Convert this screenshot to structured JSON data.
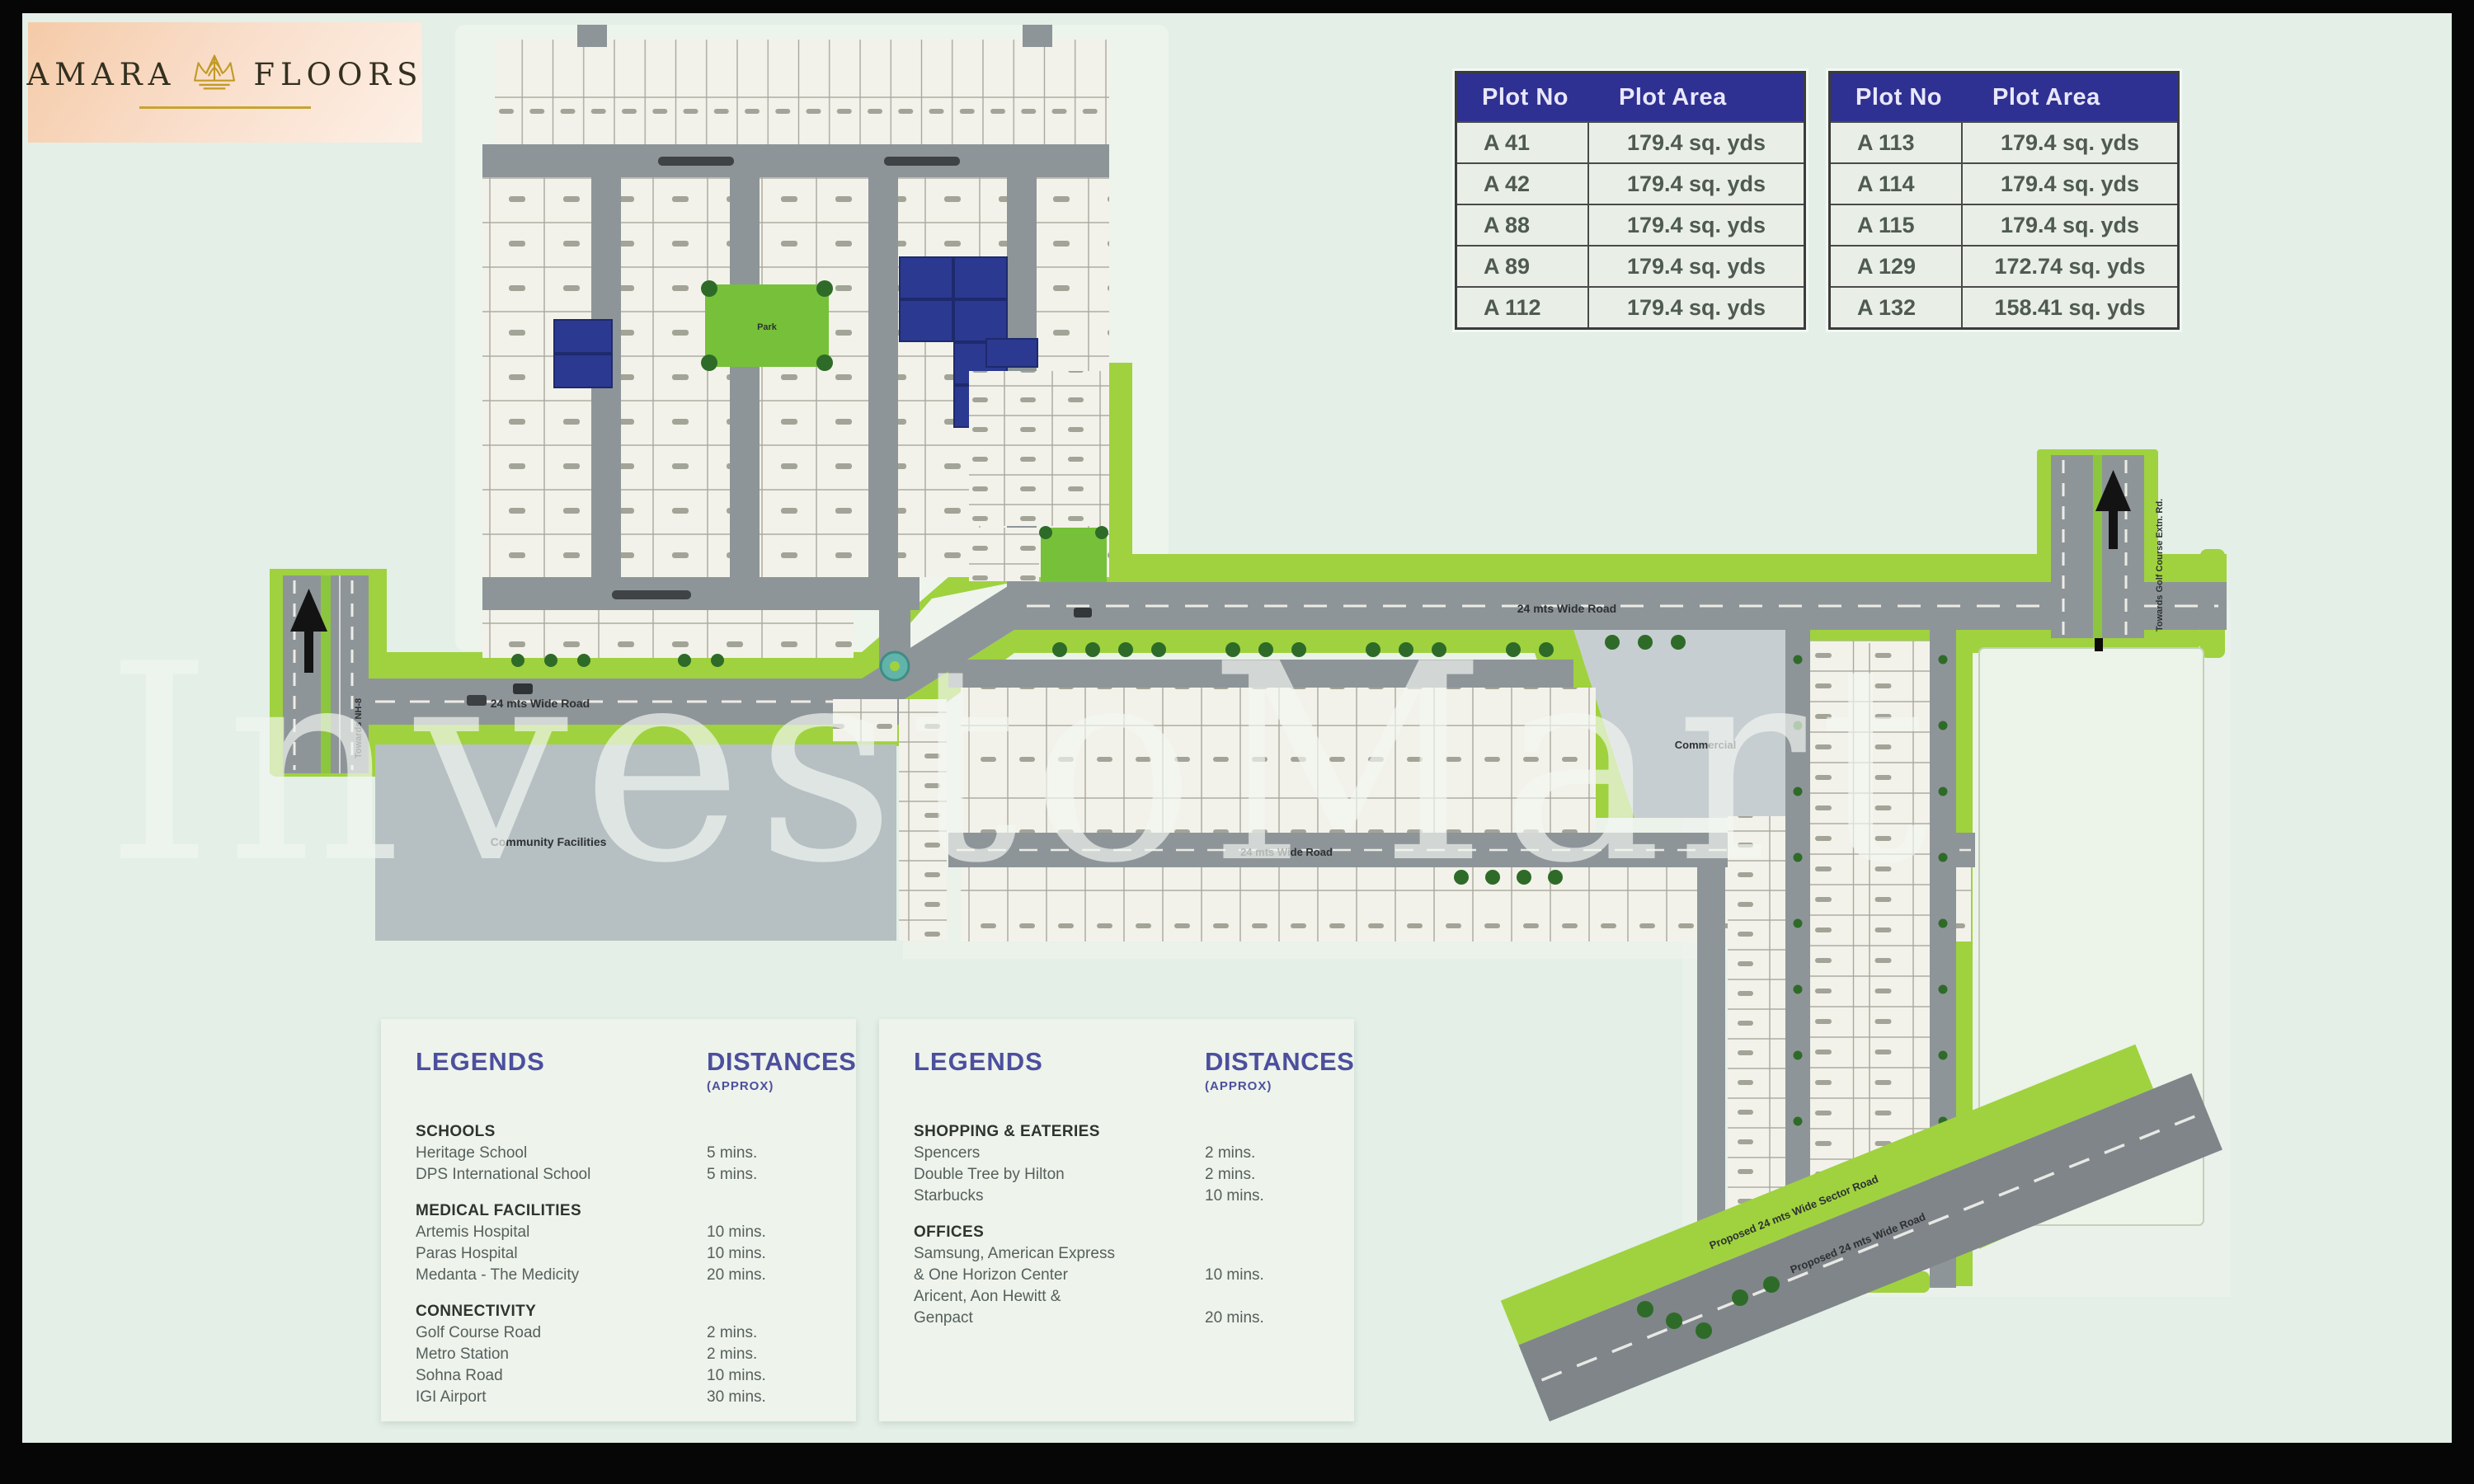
{
  "page": {
    "watermark_text": "InvestoMart",
    "background": "#e3efe7",
    "frame_color": "#060606"
  },
  "logo": {
    "brand_left": "AMARA",
    "brand_right": "FLOORS",
    "icon": "crown-icon",
    "panel_color": "#f5cba8",
    "gold": "#c19a26"
  },
  "plot_tables": [
    {
      "headers": [
        "Plot No",
        "Plot Area"
      ],
      "rows": [
        [
          "A 41",
          "179.4 sq. yds"
        ],
        [
          "A 42",
          "179.4 sq. yds"
        ],
        [
          "A 88",
          "179.4 sq. yds"
        ],
        [
          "A 89",
          "179.4 sq. yds"
        ],
        [
          "A 112",
          "179.4 sq. yds"
        ]
      ]
    },
    {
      "headers": [
        "Plot No",
        "Plot Area"
      ],
      "rows": [
        [
          "A 113",
          "179.4 sq. yds"
        ],
        [
          "A 114",
          "179.4 sq. yds"
        ],
        [
          "A 115",
          "179.4 sq. yds"
        ],
        [
          "A 129",
          "172.74 sq. yds"
        ],
        [
          "A 132",
          "158.41 sq. yds"
        ]
      ]
    }
  ],
  "legend_panels": [
    {
      "legends_title": "LEGENDS",
      "distances_title": "DISTANCES",
      "distances_sub": "(APPROX)",
      "sections": [
        {
          "title": "SCHOOLS",
          "items": [
            {
              "name": "Heritage School",
              "distance": "5 mins."
            },
            {
              "name": "DPS International School",
              "distance": "5 mins."
            }
          ]
        },
        {
          "title": "MEDICAL FACILITIES",
          "items": [
            {
              "name": "Artemis Hospital",
              "distance": "10 mins."
            },
            {
              "name": "Paras Hospital",
              "distance": "10 mins."
            },
            {
              "name": "Medanta - The Medicity",
              "distance": "20 mins."
            }
          ]
        },
        {
          "title": "CONNECTIVITY",
          "items": [
            {
              "name": "Golf Course Road",
              "distance": "2 mins."
            },
            {
              "name": "Metro Station",
              "distance": "2 mins."
            },
            {
              "name": "Sohna Road",
              "distance": "10 mins."
            },
            {
              "name": "IGI Airport",
              "distance": "30 mins."
            }
          ]
        }
      ]
    },
    {
      "legends_title": "LEGENDS",
      "distances_title": "DISTANCES",
      "distances_sub": "(APPROX)",
      "sections": [
        {
          "title": "SHOPPING & EATERIES",
          "items": [
            {
              "name": "Spencers",
              "distance": "2 mins."
            },
            {
              "name": "Double Tree by Hilton",
              "distance": "2 mins."
            },
            {
              "name": "Starbucks",
              "distance": "10 mins."
            }
          ]
        },
        {
          "title": "OFFICES",
          "items": [
            {
              "name": "Samsung, American Express\n& One Horizon Center",
              "distance": "10 mins."
            },
            {
              "name": "Aricent, Aon Hewitt &\nGenpact",
              "distance": "20 mins."
            }
          ]
        }
      ]
    }
  ],
  "map": {
    "labels": {
      "road_west": "24 mts Wide Road",
      "road_main": "24 mts Wide Road",
      "road_internal": "24 mts Wide Road",
      "community": "Community Facilities",
      "commercial": "Commercial",
      "park": "Park",
      "towards_left": "Towards NH-8",
      "towards_right": "Towards Golf Course Extn. Rd.",
      "proposed_sector_road": "Proposed 24 mts Wide Sector Road",
      "proposed_road": "Proposed 24 mts Wide Road"
    },
    "colors": {
      "road": "#8e9599",
      "green": "#9fd23e",
      "dark_green": "#2e6b28",
      "plot": "#f3f2ea",
      "highlight_blue": "#2b3990",
      "community_grey": "#b6bfc1",
      "commercial_grey": "#c7ced1",
      "park_green": "#76c139",
      "header_blue": "#2e3192",
      "legend_indigo": "#4c4f9d"
    }
  }
}
